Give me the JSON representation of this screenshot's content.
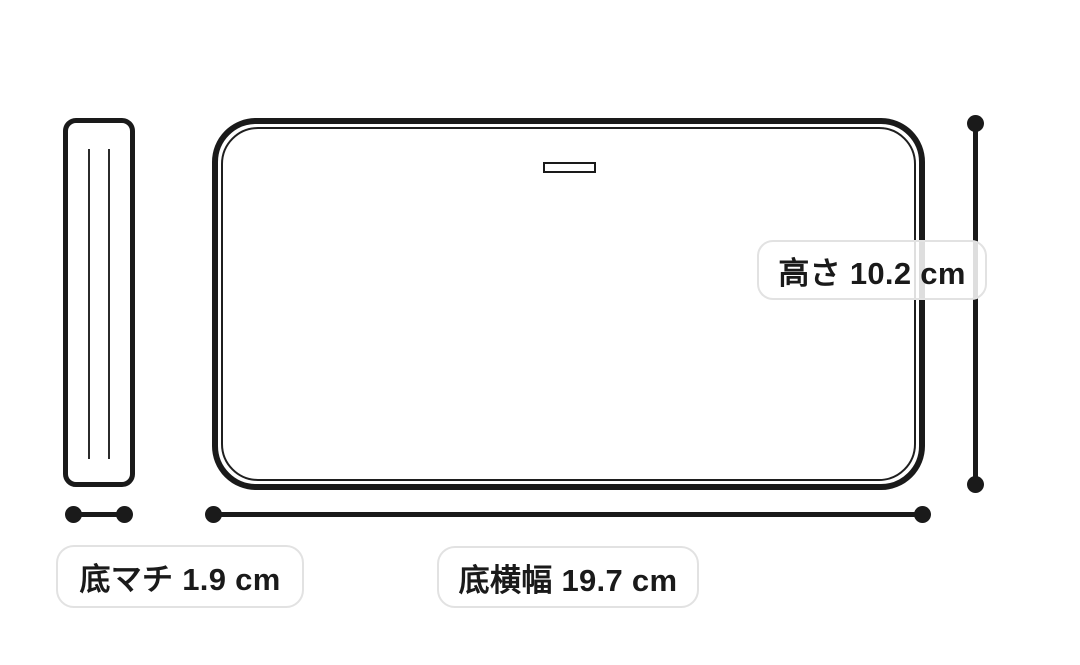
{
  "diagram": {
    "kind": "product-dimension-diagram",
    "colors": {
      "background": "#ffffff",
      "line": "#1a1a1a",
      "label_border": "#e2e2e2",
      "label_background": "rgba(255,255,255,0.86)",
      "label_text": "#1a1a1a"
    },
    "measurements": [
      {
        "id": "height",
        "label": "高さ",
        "value": "10.2",
        "unit": "cm",
        "text": "高さ 10.2 cm"
      },
      {
        "id": "bottom-width",
        "label": "底横幅",
        "value": "19.7",
        "unit": "cm",
        "text": "底横幅 19.7 cm"
      },
      {
        "id": "bottom-gusset",
        "label": "底マチ",
        "value": "1.9",
        "unit": "cm",
        "text": "底マチ 1.9 cm"
      }
    ]
  }
}
